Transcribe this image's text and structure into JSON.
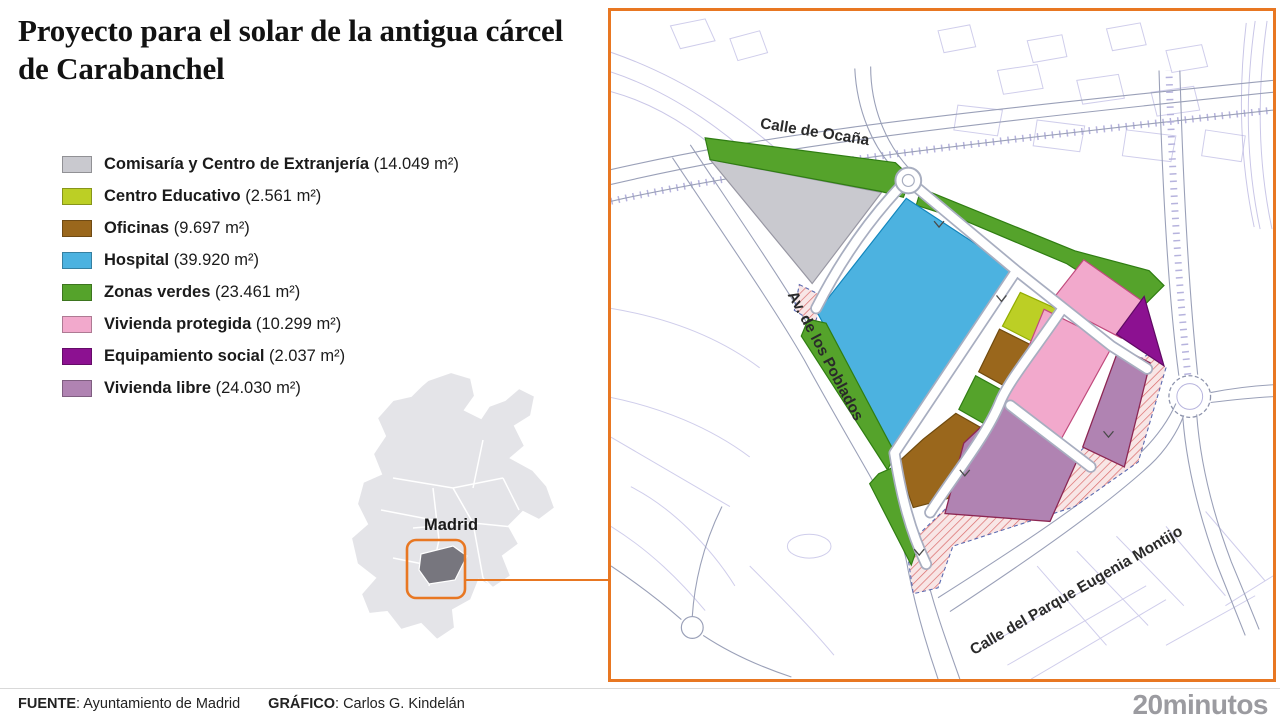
{
  "title": "Proyecto para el solar de la antigua cárcel de Carabanchel",
  "accent_color": "#e87722",
  "legend": {
    "items": [
      {
        "label": "Comisaría y Centro de Extranjería",
        "area": "(14.049 m²)",
        "color": "#c9c9cf"
      },
      {
        "label": "Centro Educativo",
        "area": "(2.561 m²)",
        "color": "#bccf25"
      },
      {
        "label": "Oficinas",
        "area": "(9.697 m²)",
        "color": "#9a671c"
      },
      {
        "label": "Hospital",
        "area": "(39.920 m²)",
        "color": "#4cb2e0"
      },
      {
        "label": "Zonas verdes",
        "area": "(23.461 m²)",
        "color": "#55a32b"
      },
      {
        "label": "Vivienda protegida",
        "area": "(10.299 m²)",
        "color": "#f2a9cc"
      },
      {
        "label": "Equipamiento social",
        "area": "(2.037 m²)",
        "color": "#8c1191"
      },
      {
        "label": "Vivienda libre",
        "area": "(24.030 m²)",
        "color": "#b083b2"
      }
    ]
  },
  "minimap": {
    "city_label": "Madrid",
    "highlight_color": "#77767e"
  },
  "map": {
    "street_labels": {
      "ocana": "Calle de Ocaña",
      "poblados": "Av. de los Poblados",
      "montijo": "Calle del Parque Eugenia Montijo"
    }
  },
  "chart_data": {
    "type": "table",
    "title": "Proyecto para el solar de la antigua cárcel de Carabanchel",
    "categories": [
      "Comisaría y Centro de Extranjería",
      "Centro Educativo",
      "Oficinas",
      "Hospital",
      "Zonas verdes",
      "Vivienda protegida",
      "Equipamiento social",
      "Vivienda libre"
    ],
    "values": [
      14049,
      2561,
      9697,
      39920,
      23461,
      10299,
      2037,
      24030
    ],
    "unit": "m²"
  },
  "footer": {
    "source_label": "FUENTE",
    "source": ": Ayuntamiento de Madrid",
    "credit_label": "GRÁFICO",
    "credit": ": Carlos G. Kindelán"
  },
  "logo": "20minutos"
}
